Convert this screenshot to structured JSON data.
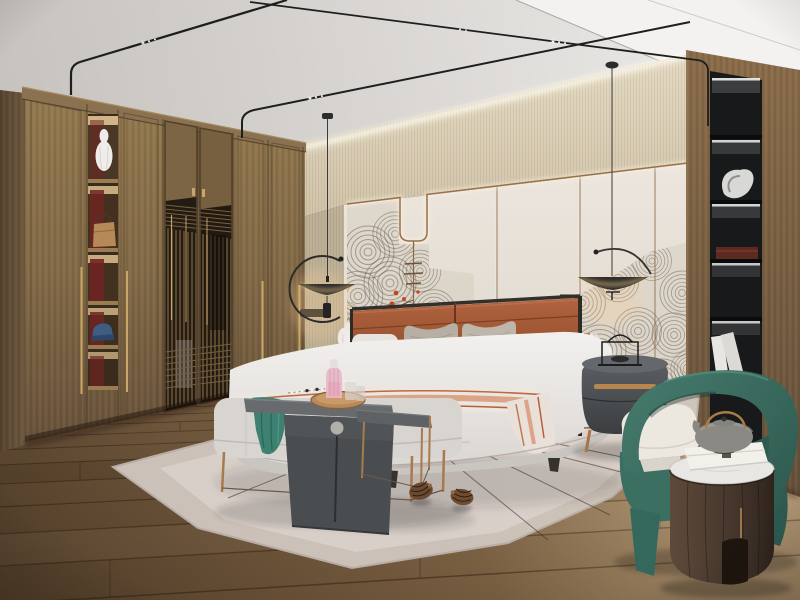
{
  "image": {
    "kind": "photorealistic-interior-render",
    "subject": "modern chinese style bedroom"
  },
  "palette": {
    "ceiling": "#d9d6d2",
    "bulkhead": "#f3f2f0",
    "cove_band": "#d7cbb2",
    "wall_cream": "#e7e1d8",
    "copper_trim": "#96714c",
    "mural_line": "#6f675c",
    "mural_red": "#c2471f",
    "wood_wardrobe": "#846b4a",
    "wood_column": "#7a5f42",
    "lattice_dark": "#241c12",
    "niche_red": "#6f2522",
    "niche_black": "#17191b",
    "floor_wood": "#8a6d4c",
    "rug": "#cbc1b8",
    "bed_white": "#eeecea",
    "bed_base": "#c9c5c1",
    "headboard_leather": "#a05638",
    "pillow_teal": "#4e8678",
    "throw_teal": "#3d8172",
    "stripe_terracotta": "#b4613c",
    "chair_green": "#3d7468",
    "cushion_cream": "#ece8e0",
    "table_gray": "#55585a",
    "nightstand_gray": "#4e5154",
    "brass": "#b8854f",
    "led_warm": "#ffd894",
    "cylinder_wood": "#4a3a2e",
    "pink_glass": "#e8b8c8",
    "marble": "#e9e7e3"
  },
  "objects": [
    "ceiling-track-lights",
    "cove-lighting",
    "pendant-lamp-left",
    "pendant-lamp-right",
    "wardrobe",
    "wardrobe-display-column",
    "lattice-doors",
    "vase-white",
    "handbag",
    "cap-blue",
    "feature-wall",
    "cloud-mural",
    "copper-wall-trim",
    "red-blossoms",
    "display-niche",
    "sculpture",
    "keepsake-box",
    "books",
    "bed",
    "headboard",
    "pillows",
    "teal-lumbar-pillow",
    "bolster",
    "striped-throw",
    "bench",
    "teal-throw",
    "waterfall-side-table",
    "nesting-side-table",
    "serving-tray",
    "pink-decanter",
    "glasses",
    "bead-garland",
    "nightstand-left",
    "nightstand-right",
    "wire-lantern",
    "area-rug",
    "pine-cones",
    "armchair-green",
    "drum-side-table",
    "teapot",
    "gift-box",
    "wood-floor"
  ]
}
